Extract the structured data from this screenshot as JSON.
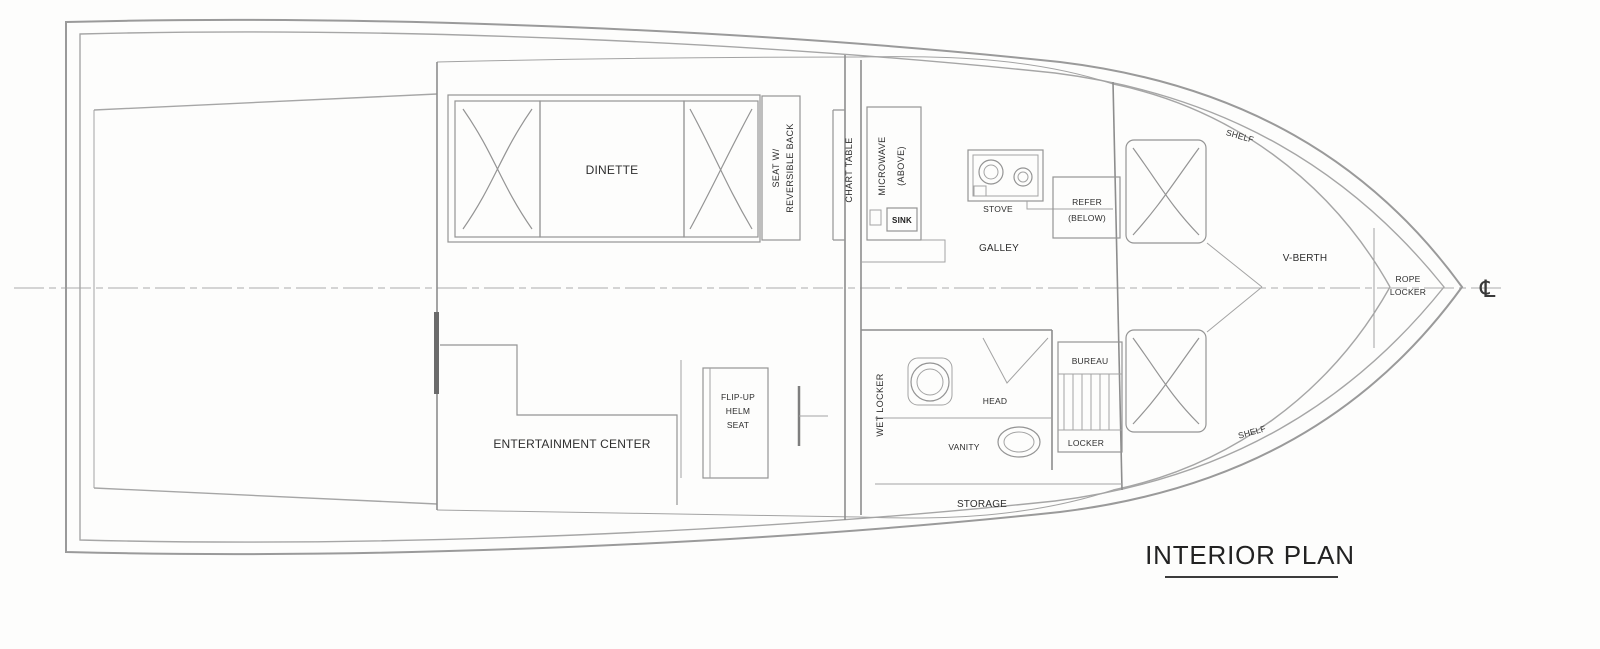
{
  "drawing": {
    "title": "INTERIOR PLAN",
    "centerline_symbol": "℄",
    "saloon": {
      "dinette": "DINETTE",
      "seat_back_line1": "SEAT W/",
      "seat_back_line2": "REVERSIBLE BACK",
      "chart_table": "CHART TABLE"
    },
    "galley": {
      "name": "GALLEY",
      "stove": "STOVE",
      "sink": "SINK",
      "microwave_line1": "MICROWAVE",
      "microwave_line2": "(ABOVE)",
      "refer_line1": "REFER",
      "refer_line2": "(BELOW)"
    },
    "helm": {
      "entertainment_center": "ENTERTAINMENT CENTER",
      "helm_seat_line1": "FLIP-UP",
      "helm_seat_line2": "HELM",
      "helm_seat_line3": "SEAT"
    },
    "head": {
      "name": "HEAD",
      "vanity": "VANITY",
      "wet_locker": "WET LOCKER",
      "storage": "STORAGE"
    },
    "forward_cabin": {
      "v_berth": "V-BERTH",
      "shelf_upper": "SHELF",
      "shelf_lower": "SHELF",
      "bureau": "BUREAU",
      "locker": "LOCKER",
      "rope_locker_line1": "ROPE",
      "rope_locker_line2": "LOCKER"
    }
  }
}
